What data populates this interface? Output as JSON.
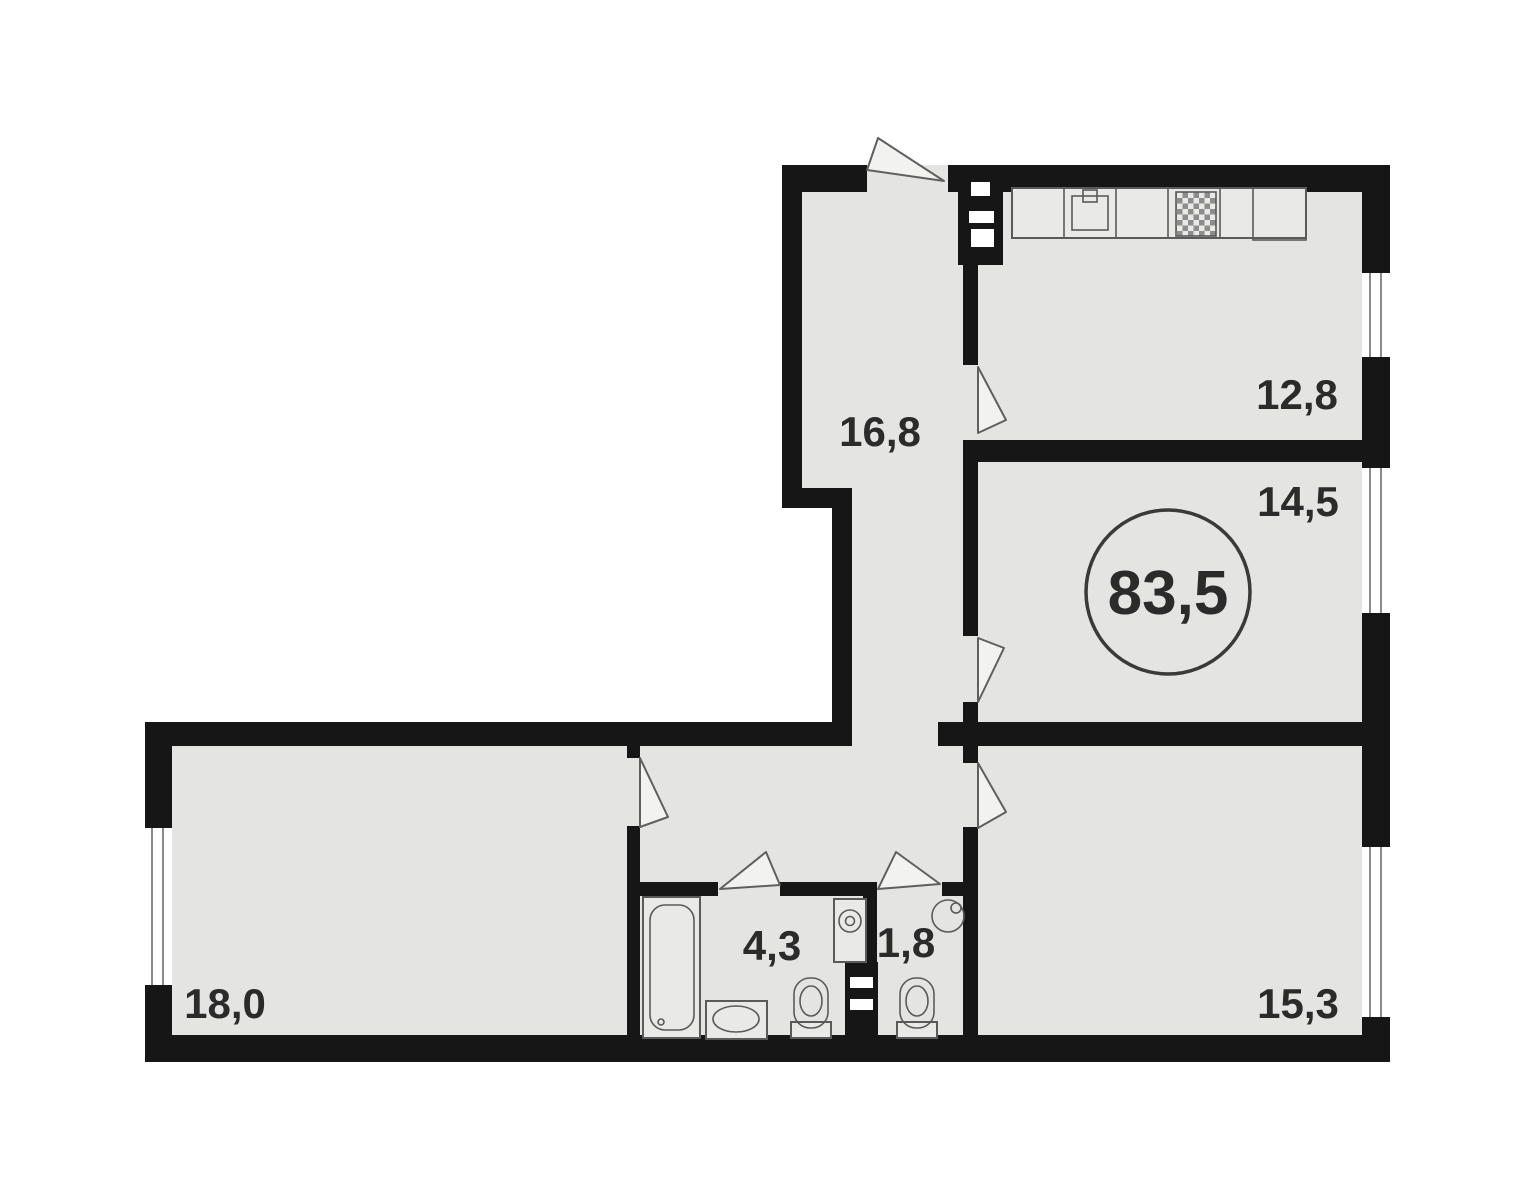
{
  "floorplan": {
    "total_area_label": "83,5",
    "rooms": [
      {
        "id": "hallway",
        "area_label": "16,8"
      },
      {
        "id": "kitchen",
        "area_label": "12,8"
      },
      {
        "id": "room-top-right",
        "area_label": "14,5"
      },
      {
        "id": "room-bottom-left",
        "area_label": "18,0"
      },
      {
        "id": "bathroom",
        "area_label": "4,3"
      },
      {
        "id": "wc",
        "area_label": "1,8"
      },
      {
        "id": "room-bottom-right",
        "area_label": "15,3"
      }
    ],
    "fixtures": [
      "kitchen-counter",
      "kitchen-sink",
      "stove",
      "vent-shaft",
      "bathtub",
      "washbasin",
      "toilet",
      "washing-machine",
      "toilet",
      "corner-washbasin",
      "vent-shaft"
    ],
    "colors": {
      "wall": "#161616",
      "floor": "#e4e5e2",
      "background": "#ffffff",
      "fixture_line": "#5a5a5a",
      "window_line": "#8a8a8a",
      "door_fill": "#f2f3f1",
      "text": "#2b2b2b"
    }
  }
}
